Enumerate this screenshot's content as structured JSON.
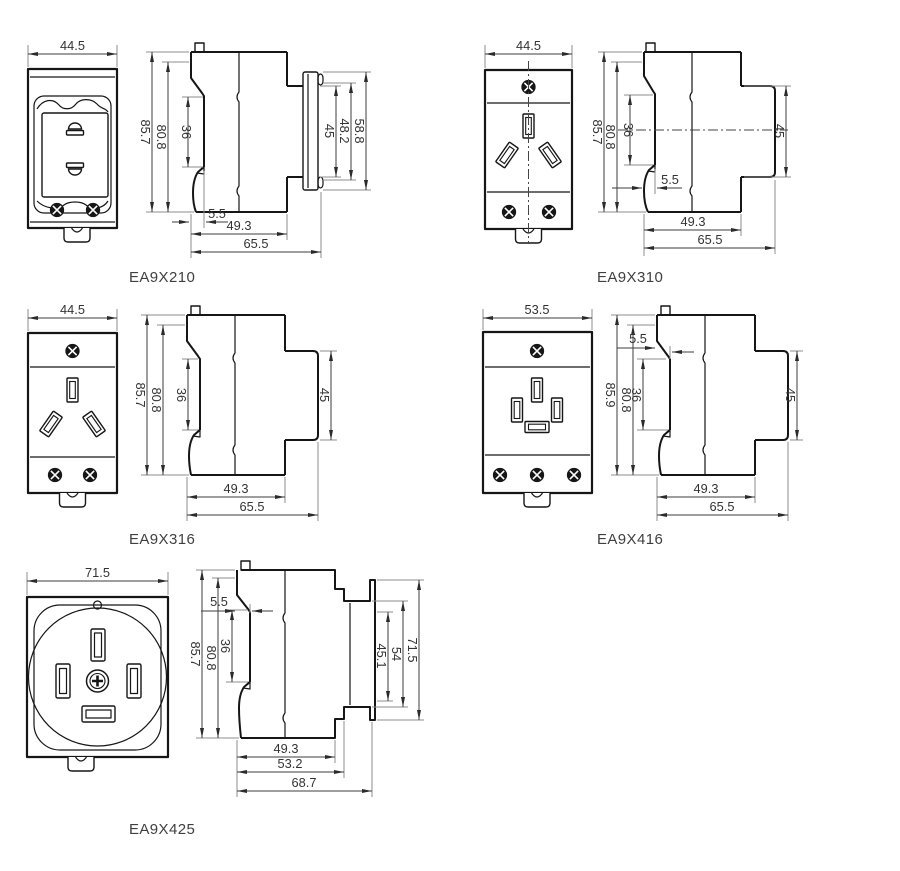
{
  "sheet": {
    "background": "#ffffff",
    "outline_color": "#161616",
    "dim_line_color": "#3d3d3d",
    "ext_line_color": "#8c8c8c",
    "text_color": "#333333"
  },
  "drawings": [
    {
      "name": "EA9X210",
      "dims": {
        "width": "44.5",
        "height": "85.7",
        "body_height": "80.8",
        "rail_notch": "36",
        "rail_offset": "5.5",
        "depth": "49.3",
        "total_depth": "65.5",
        "face_inner": "45",
        "face_mid": "48.2",
        "face_outer": "58.8"
      }
    },
    {
      "name": "EA9X310",
      "dims": {
        "width": "44.5",
        "height": "85.7",
        "body_height": "80.8",
        "rail_notch": "36",
        "rail_offset": "5.5",
        "depth": "49.3",
        "total_depth": "65.5",
        "face_inner": "45"
      }
    },
    {
      "name": "EA9X316",
      "dims": {
        "width": "44.5",
        "height": "85.7",
        "body_height": "80.8",
        "rail_notch": "36",
        "depth": "49.3",
        "total_depth": "65.5",
        "face_inner": "45"
      }
    },
    {
      "name": "EA9X416",
      "dims": {
        "width": "53.5",
        "height": "85.9",
        "body_height": "80.8",
        "rail_notch": "36",
        "rail_offset": "5.5",
        "depth": "49.3",
        "total_depth": "65.5",
        "face_inner": "45"
      }
    },
    {
      "name": "EA9X425",
      "dims": {
        "width": "71.5",
        "height": "85.7",
        "body_height": "80.8",
        "rail_notch": "36",
        "rail_offset": "5.5",
        "depth": "49.3",
        "mid_depth": "53.2",
        "total_depth": "68.7",
        "face_inner": "45.1",
        "face_mid": "54",
        "face_outer": "71.5"
      }
    }
  ]
}
